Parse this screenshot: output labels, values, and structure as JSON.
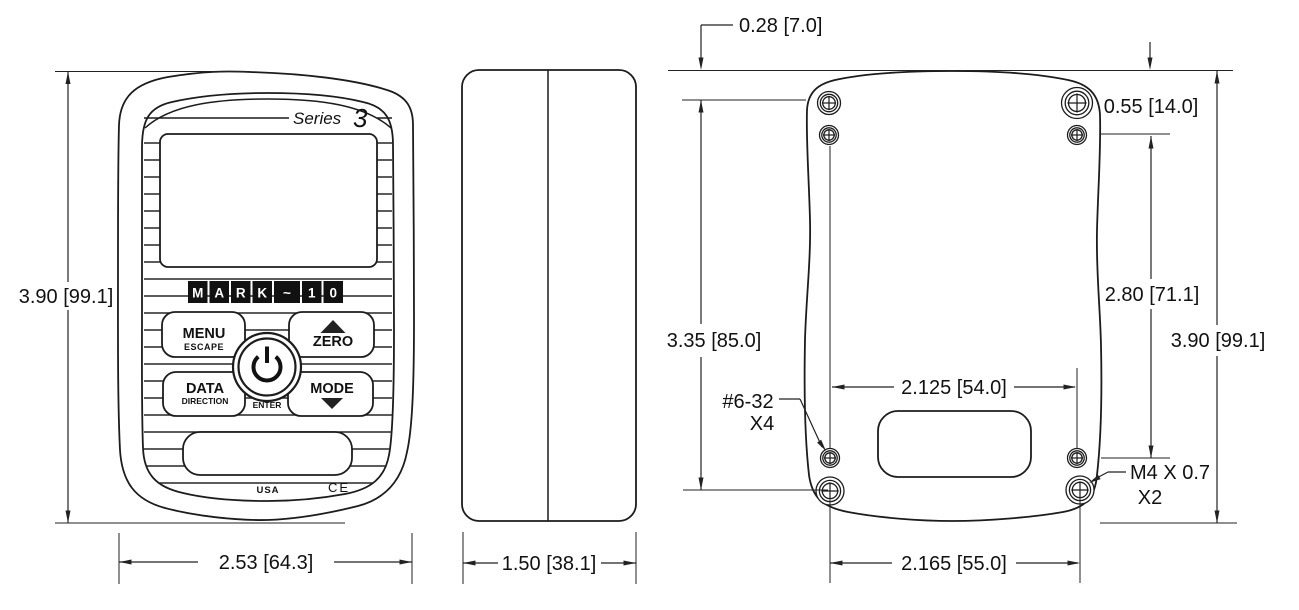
{
  "front_view": {
    "series_label": "Series",
    "series_number": "3",
    "logo_letters": [
      "M",
      "A",
      "R",
      "K",
      "~",
      "1",
      "0"
    ],
    "buttons": {
      "menu": "MENU",
      "escape": "ESCAPE",
      "zero": "ZERO",
      "data": "DATA",
      "direction": "DIRECTION",
      "mode": "MODE",
      "enter": "ENTER"
    },
    "footer": {
      "origin": "USA",
      "ce_mark": "CE"
    },
    "dimensions": {
      "height": "3.90 [99.1]",
      "width": "2.53 [64.3]"
    }
  },
  "side_view": {
    "dimensions": {
      "depth": "1.50 [38.1]"
    }
  },
  "back_view": {
    "dimensions": {
      "top_screw_offset": "0.28 [7.0]",
      "second_screw_offset": "0.55 [14.0]",
      "left_screw_span": "3.35 [85.0]",
      "right_screw_span": "2.80 [71.1]",
      "height": "3.90 [99.1]",
      "small_screw_spacing": "2.125 [54.0]",
      "large_screw_spacing": "2.165 [55.0]"
    },
    "labels": {
      "small_thread_spec": "#6-32",
      "small_thread_qty": "X4",
      "large_thread_spec": "M4 X 0.7",
      "large_thread_qty": "X2"
    }
  }
}
